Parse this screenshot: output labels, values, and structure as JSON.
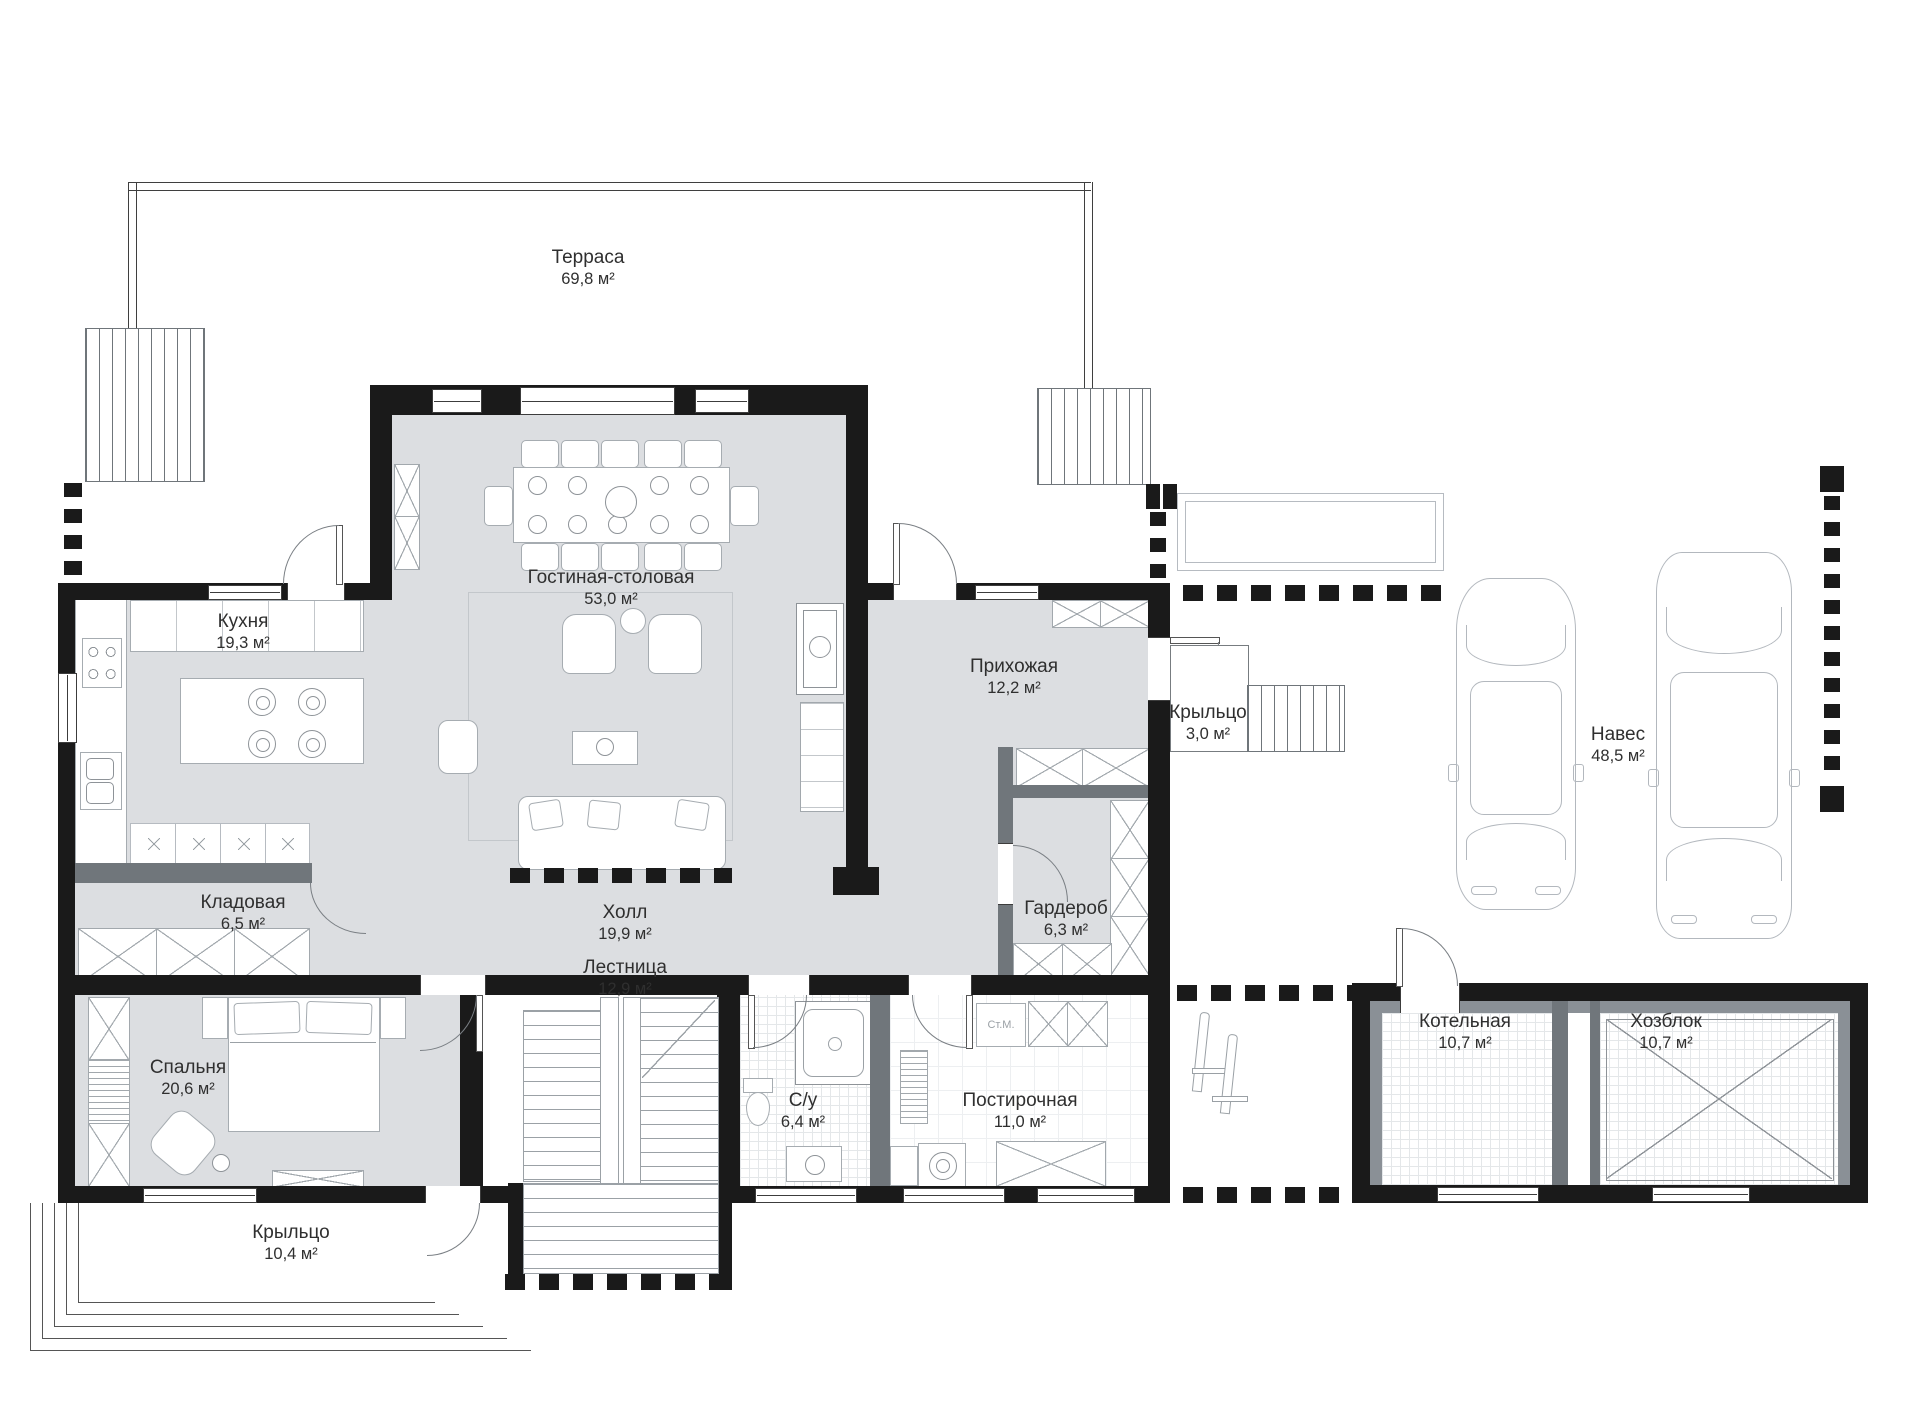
{
  "plan": {
    "title": "План 1-го этажа",
    "rooms": {
      "terrace": {
        "name": "Терраса",
        "area": "69,8 м²"
      },
      "living_dining": {
        "name": "Гостиная-столовая",
        "area": "53,0 м²"
      },
      "kitchen": {
        "name": "Кухня",
        "area": "19,3 м²"
      },
      "entry_hall": {
        "name": "Прихожая",
        "area": "12,2 м²"
      },
      "entry_porch": {
        "name": "Крыльцо",
        "area": "3,0 м²"
      },
      "carport": {
        "name": "Навес",
        "area": "48,5 м²"
      },
      "storage": {
        "name": "Кладовая",
        "area": "6,5 м²"
      },
      "hall": {
        "name": "Холл",
        "area": "19,9 м²"
      },
      "stairs": {
        "name": "Лестница",
        "area": "12,9 м²"
      },
      "wardrobe": {
        "name": "Гардероб",
        "area": "6,3 м²"
      },
      "bedroom": {
        "name": "Спальня",
        "area": "20,6 м²"
      },
      "bathroom": {
        "name": "С/у",
        "area": "6,4 м²"
      },
      "laundry": {
        "name": "Постирочная",
        "area": "11,0 м²",
        "washing_machine_label": "Ст.М."
      },
      "boiler_room": {
        "name": "Котельная",
        "area": "10,7 м²"
      },
      "utility_block": {
        "name": "Хозблок",
        "area": "10,7 м²"
      },
      "main_porch": {
        "name": "Крыльцо",
        "area": "10,4 м²"
      }
    },
    "colors": {
      "wall": "#1a1a1a",
      "floor": "#dcdee1",
      "partition": "#70767b",
      "furniture_line": "#a6acb1",
      "text": "#2f2f2f"
    }
  }
}
